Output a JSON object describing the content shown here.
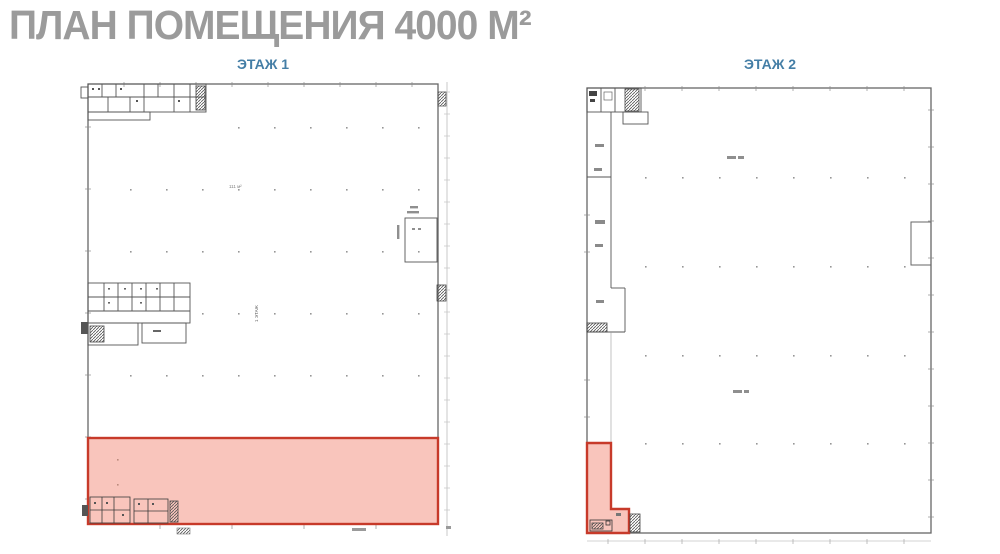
{
  "title": "ПЛАН ПОМЕЩЕНИЯ 4000 М²",
  "floor1": {
    "heading": "ЭТАЖ 1",
    "area_label": "111 м²",
    "axis_label": "1 ЭТАЖ"
  },
  "floor2": {
    "heading": "ЭТАЖ 2"
  },
  "colors": {
    "title_gray": "#9b9b9b",
    "heading_blue": "#447ea6",
    "highlight_fill": "#f9c5bc",
    "highlight_stroke": "#c73a2a",
    "plan_lines": "#666666"
  }
}
